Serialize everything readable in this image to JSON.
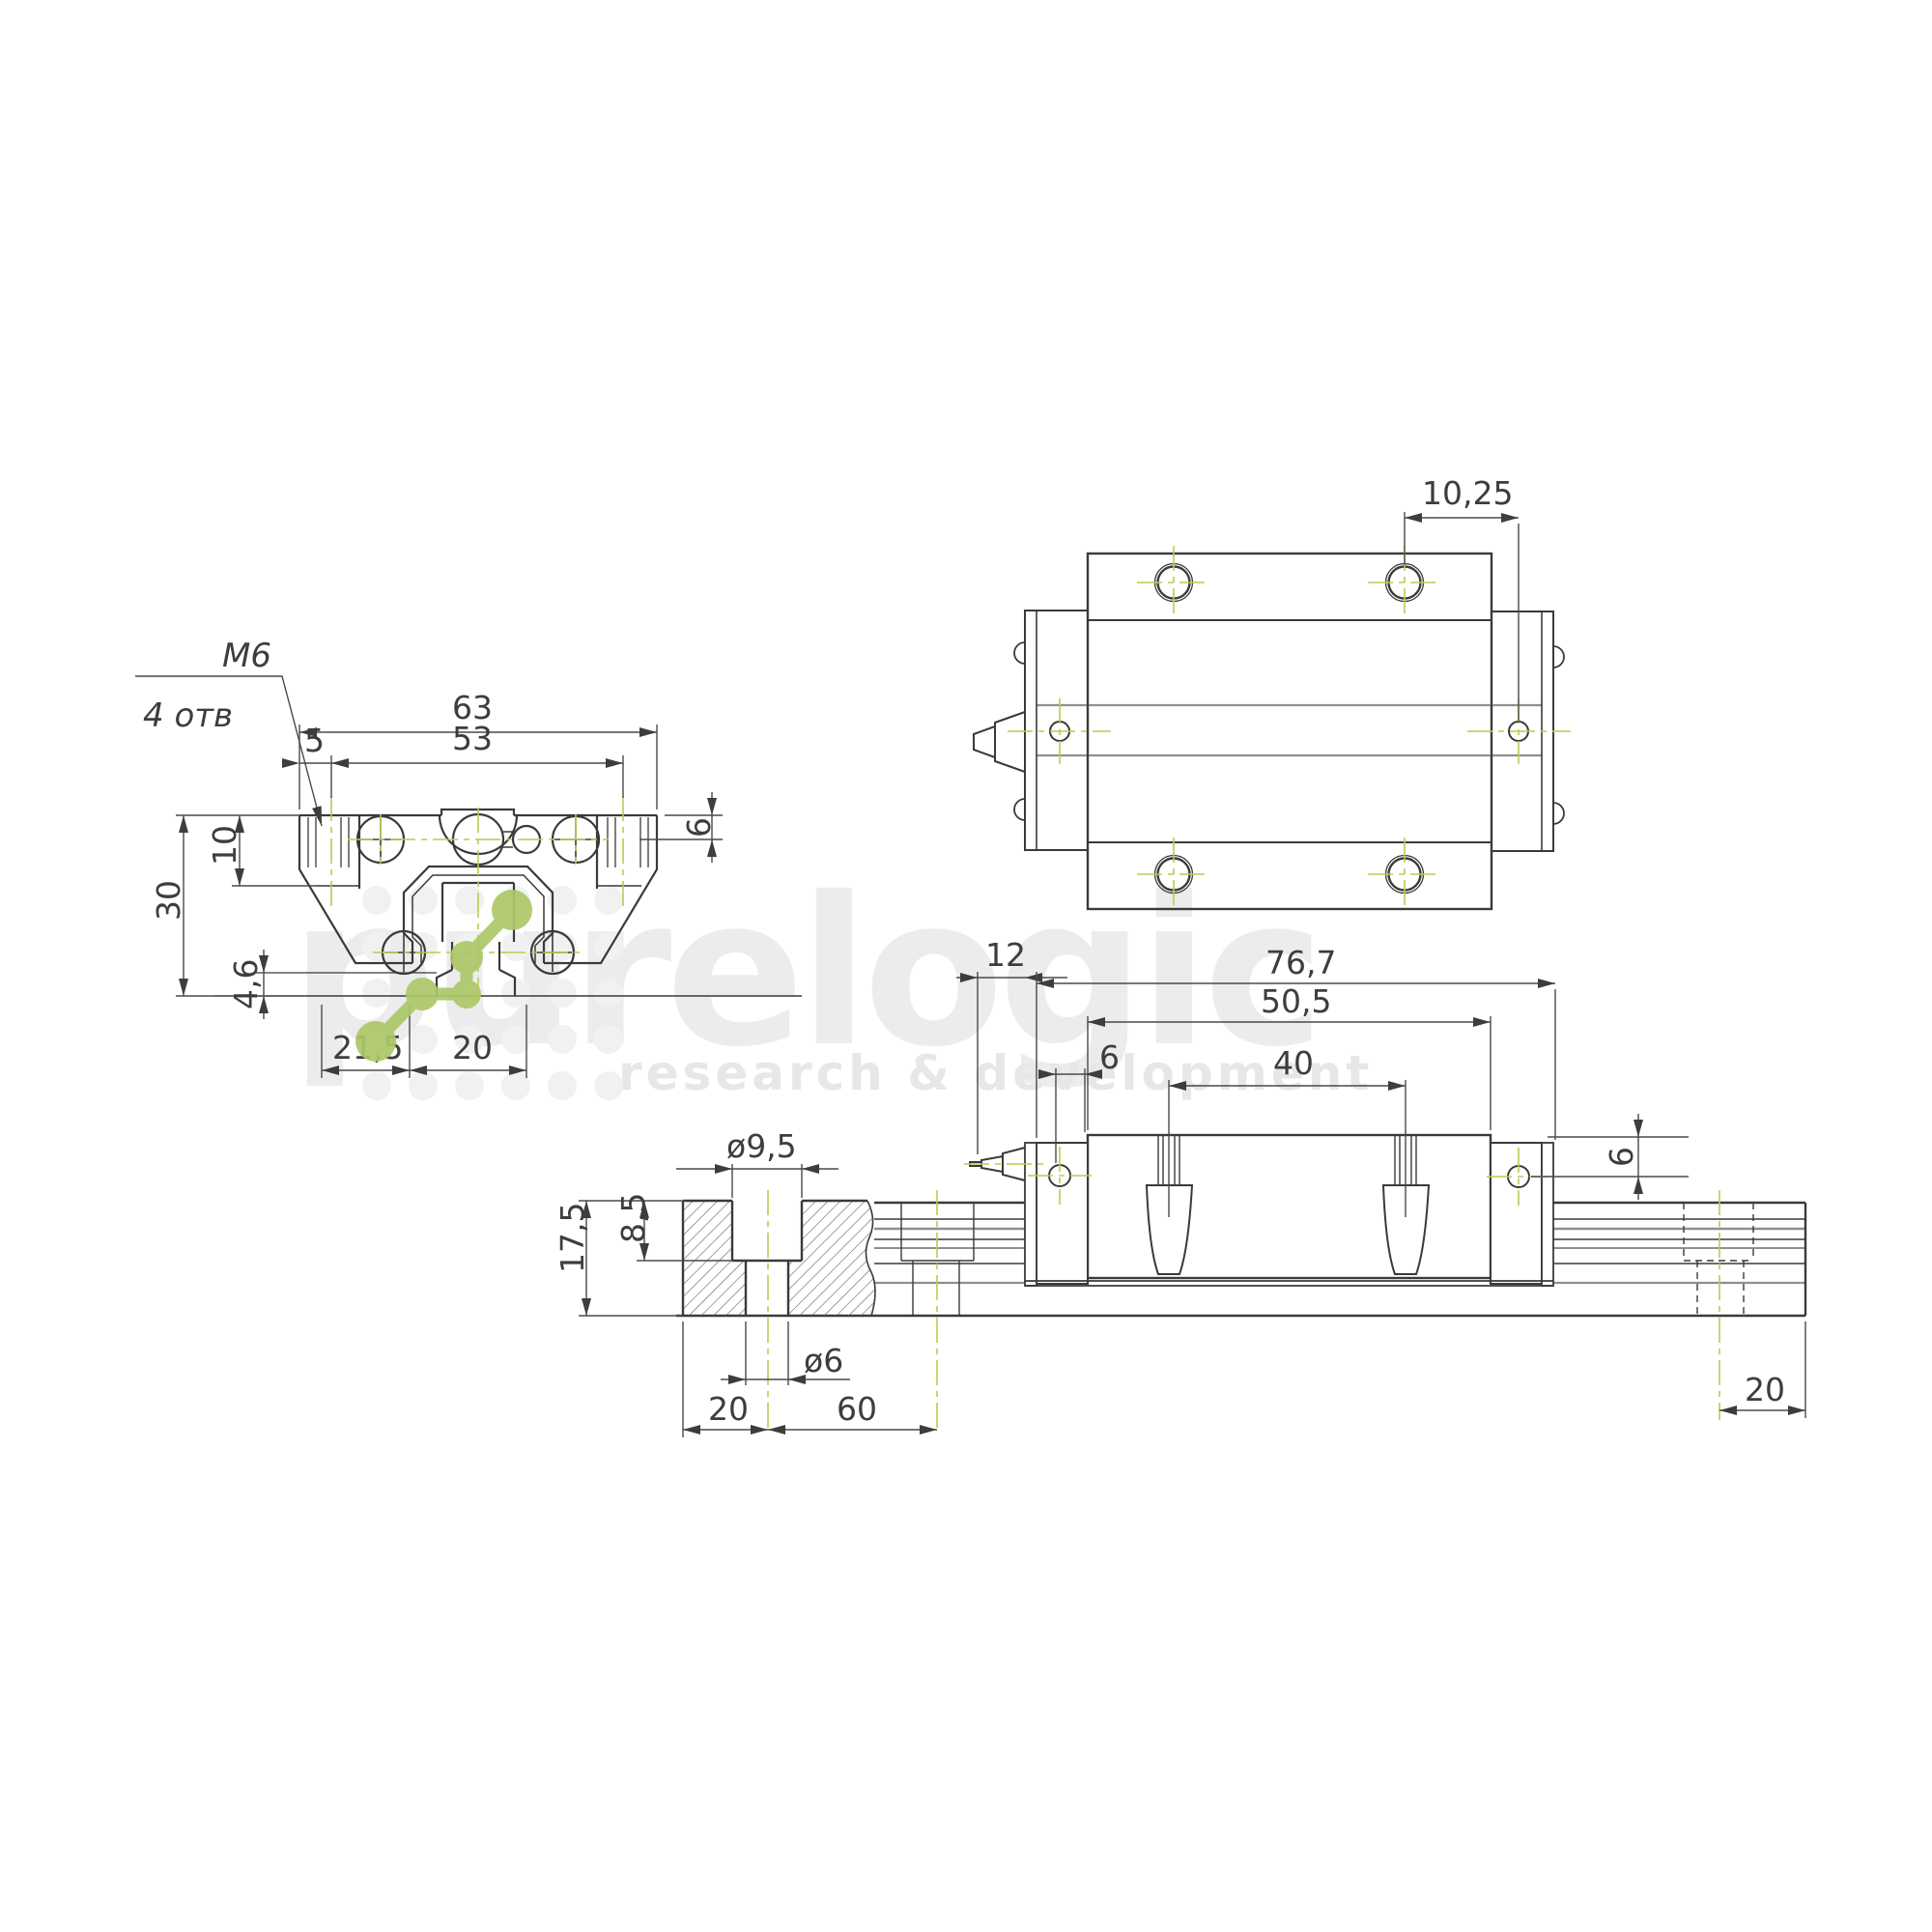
{
  "watermark": {
    "brand": "purelogic",
    "tagline": "research & development"
  },
  "colors": {
    "line": "#3a3a3a",
    "thin": "#4a4a4a",
    "gray": "#8f8f8f",
    "centerline_green": "#b9cb52",
    "logo_green": "#adc868",
    "watermark_gray": "#ececec",
    "dot_grid": "#f1f1f1"
  },
  "labels": {
    "front": {
      "thread": "М6",
      "holes": "4 отв",
      "width": "63",
      "hole_span": "53",
      "edge_offset": "5",
      "hole_depth": "6",
      "flange_height": "10",
      "height": "30",
      "rail_base": "4,6",
      "side_offset": "21,5",
      "rail_width": "20"
    },
    "top": {
      "hole_offset": "10,25"
    },
    "side": {
      "nipple": "12",
      "total_length": "76,7",
      "body_length": "50,5",
      "cap_hole_offset": "6",
      "pin_spacing": "40",
      "hole_height": "6",
      "end_hole_offset": "20"
    },
    "rail": {
      "counterbore_dia": "ø9,5",
      "counterbore_depth": "8,5",
      "height": "17,5",
      "hole_dia": "ø6",
      "edge_to_hole": "20",
      "hole_pitch": "60"
    }
  }
}
